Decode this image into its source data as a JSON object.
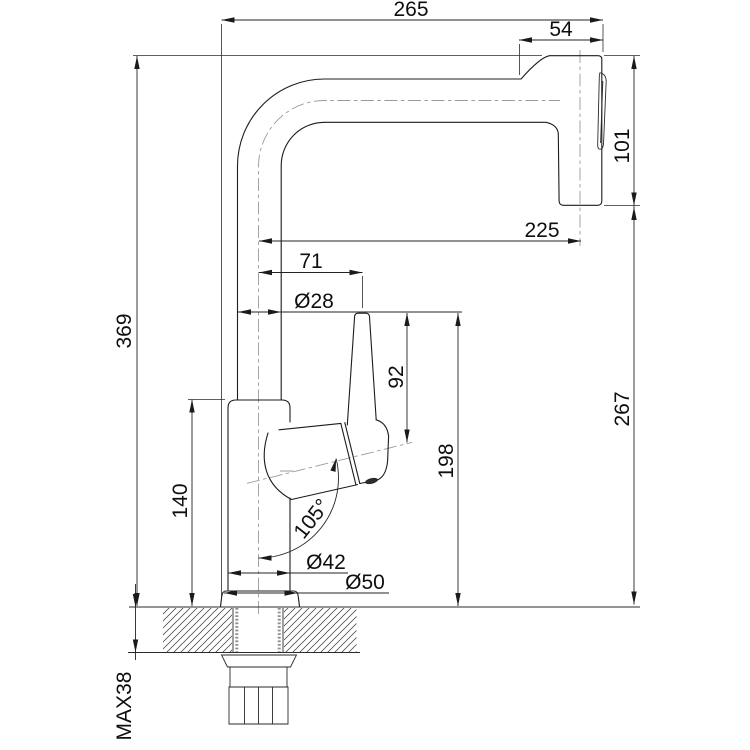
{
  "drawing": {
    "kind": "technical-dimension-drawing",
    "colors": {
      "line": "#1c1c1c",
      "centerline": "#9b9b9b",
      "background": "#ffffff"
    }
  },
  "dims": {
    "overall_width": "265",
    "head_width": "54",
    "head_height": "101",
    "spout_reach": "225",
    "handle_offset": "71",
    "pipe_diameter": "Ø28",
    "handle_rise": "92",
    "outlet_height": "198",
    "total_height": "369",
    "body_height": "140",
    "handle_angle": "105°",
    "body_diameter": "Ø42",
    "base_diameter": "Ø50",
    "right_height": "267",
    "max_counter_thickness": "MAX38"
  }
}
